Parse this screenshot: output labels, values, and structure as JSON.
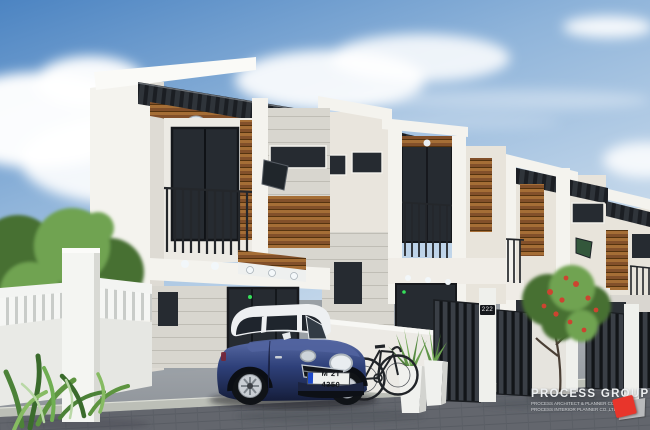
{
  "scene": {
    "description": "3D architectural rendering of a row of modern two-storey townhouses with a blue Mini Cooper and bicycle parked in the front driveway"
  },
  "watermark": {
    "title": "PROCESS GROUP",
    "line1": "PROCESS ARCHITECT & PLANNER CO.,LTD",
    "line2": "PROCESS INTERIOR PLANNER CO.,LTD."
  },
  "car": {
    "license_plate": "M 2T 4350"
  },
  "house_number": "222",
  "colors": {
    "sky_top": "#4c84c2",
    "sky_mid": "#8fb4da",
    "sky_pale": "#cfdfee",
    "cloud_white": "#ffffff",
    "wall_white": "#f4f3ee",
    "wall_cream": "#e8e4db",
    "wall_gray": "#d6d3cc",
    "canopy_charcoal": "#2f343a",
    "wood_brown": "#82502a",
    "wood_light": "#a56e36",
    "window_glass": "#262b31",
    "railing_black": "#24272b",
    "gate_charcoal": "#24282d",
    "pavement_light": "#9aa0a6",
    "pavement_dark": "#63666d",
    "curb_gray": "#bcbfb7",
    "foliage_green": "#466f33",
    "foliage_light": "#6fa351",
    "flower_red": "#cc4430",
    "car_blue_light": "#5a6ca6",
    "car_blue": "#2e4079",
    "car_blue_dark": "#151d3a",
    "car_roof_white": "#eef0f2",
    "led_green": "#35e05a",
    "logo_red": "#e8352b",
    "watermark_text": "#edeff0"
  }
}
